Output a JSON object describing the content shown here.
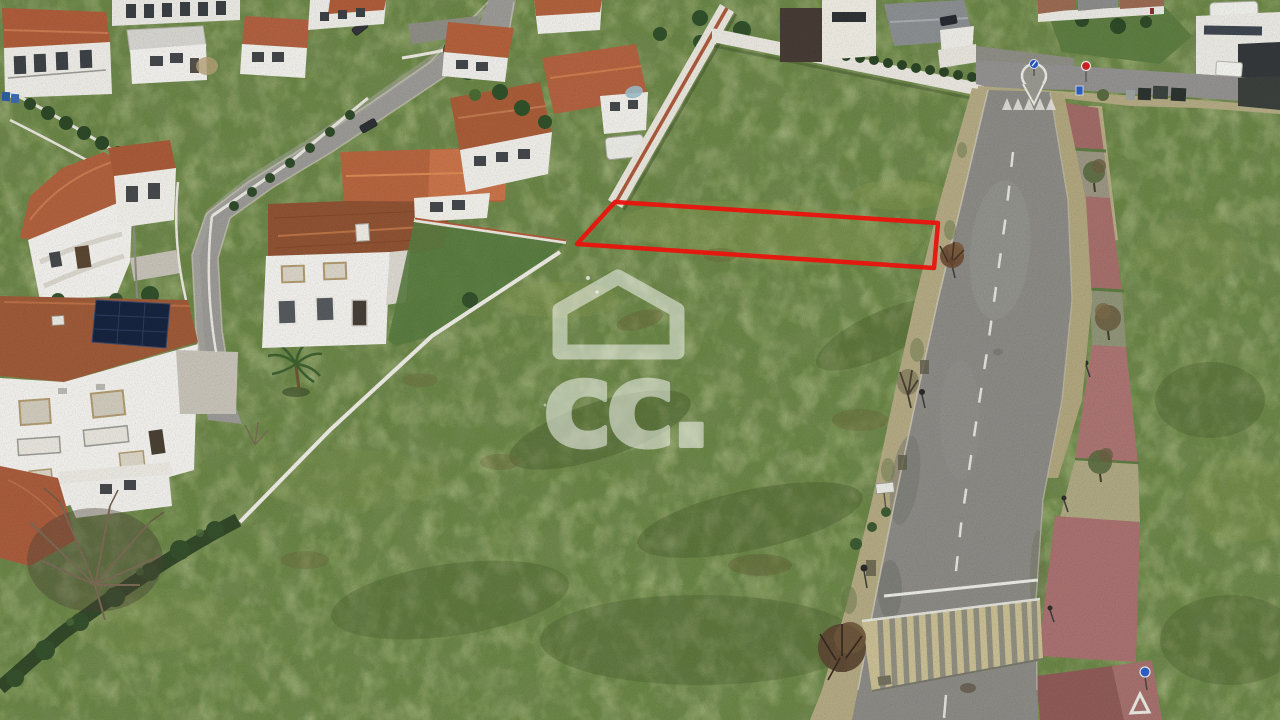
{
  "scene": {
    "type": "aerial-drone-photograph",
    "description": "Aerial view of a vacant grass land plot marked with a red outline, beside a residential neighborhood of white houses with terracotta roofs, a curved street on the left and a straight road with raised crosswalk, sidewalks, small trees and reddish parking bays on the right."
  },
  "watermark": {
    "text": "cc.",
    "icon": "house-outline-icon",
    "color": "#ffffff",
    "opacity": 0.5
  },
  "plot_outline": {
    "points": "615,202 938,223 934,268 577,244",
    "color": "#e8150f",
    "stroke_width": 4.5
  },
  "palette": {
    "grass": "#6a8546",
    "grass_dark": "#4f6a36",
    "grass_light": "#8a9b52",
    "roof_terracotta": "#a85c3a",
    "roof_bright": "#c8734a",
    "house_wall": "#efeeea",
    "road_asphalt": "#8b8a85",
    "neighborhood_street": "#9a9995",
    "sidewalk": "#b2a983",
    "crosswalk_tan": "#c8bd93",
    "parking_red": "#a87471",
    "hedge_green": "#2f4a28",
    "solar_panel": "#17243f",
    "sign_blue": "#2b5fc7",
    "sign_red": "#cc2424"
  }
}
